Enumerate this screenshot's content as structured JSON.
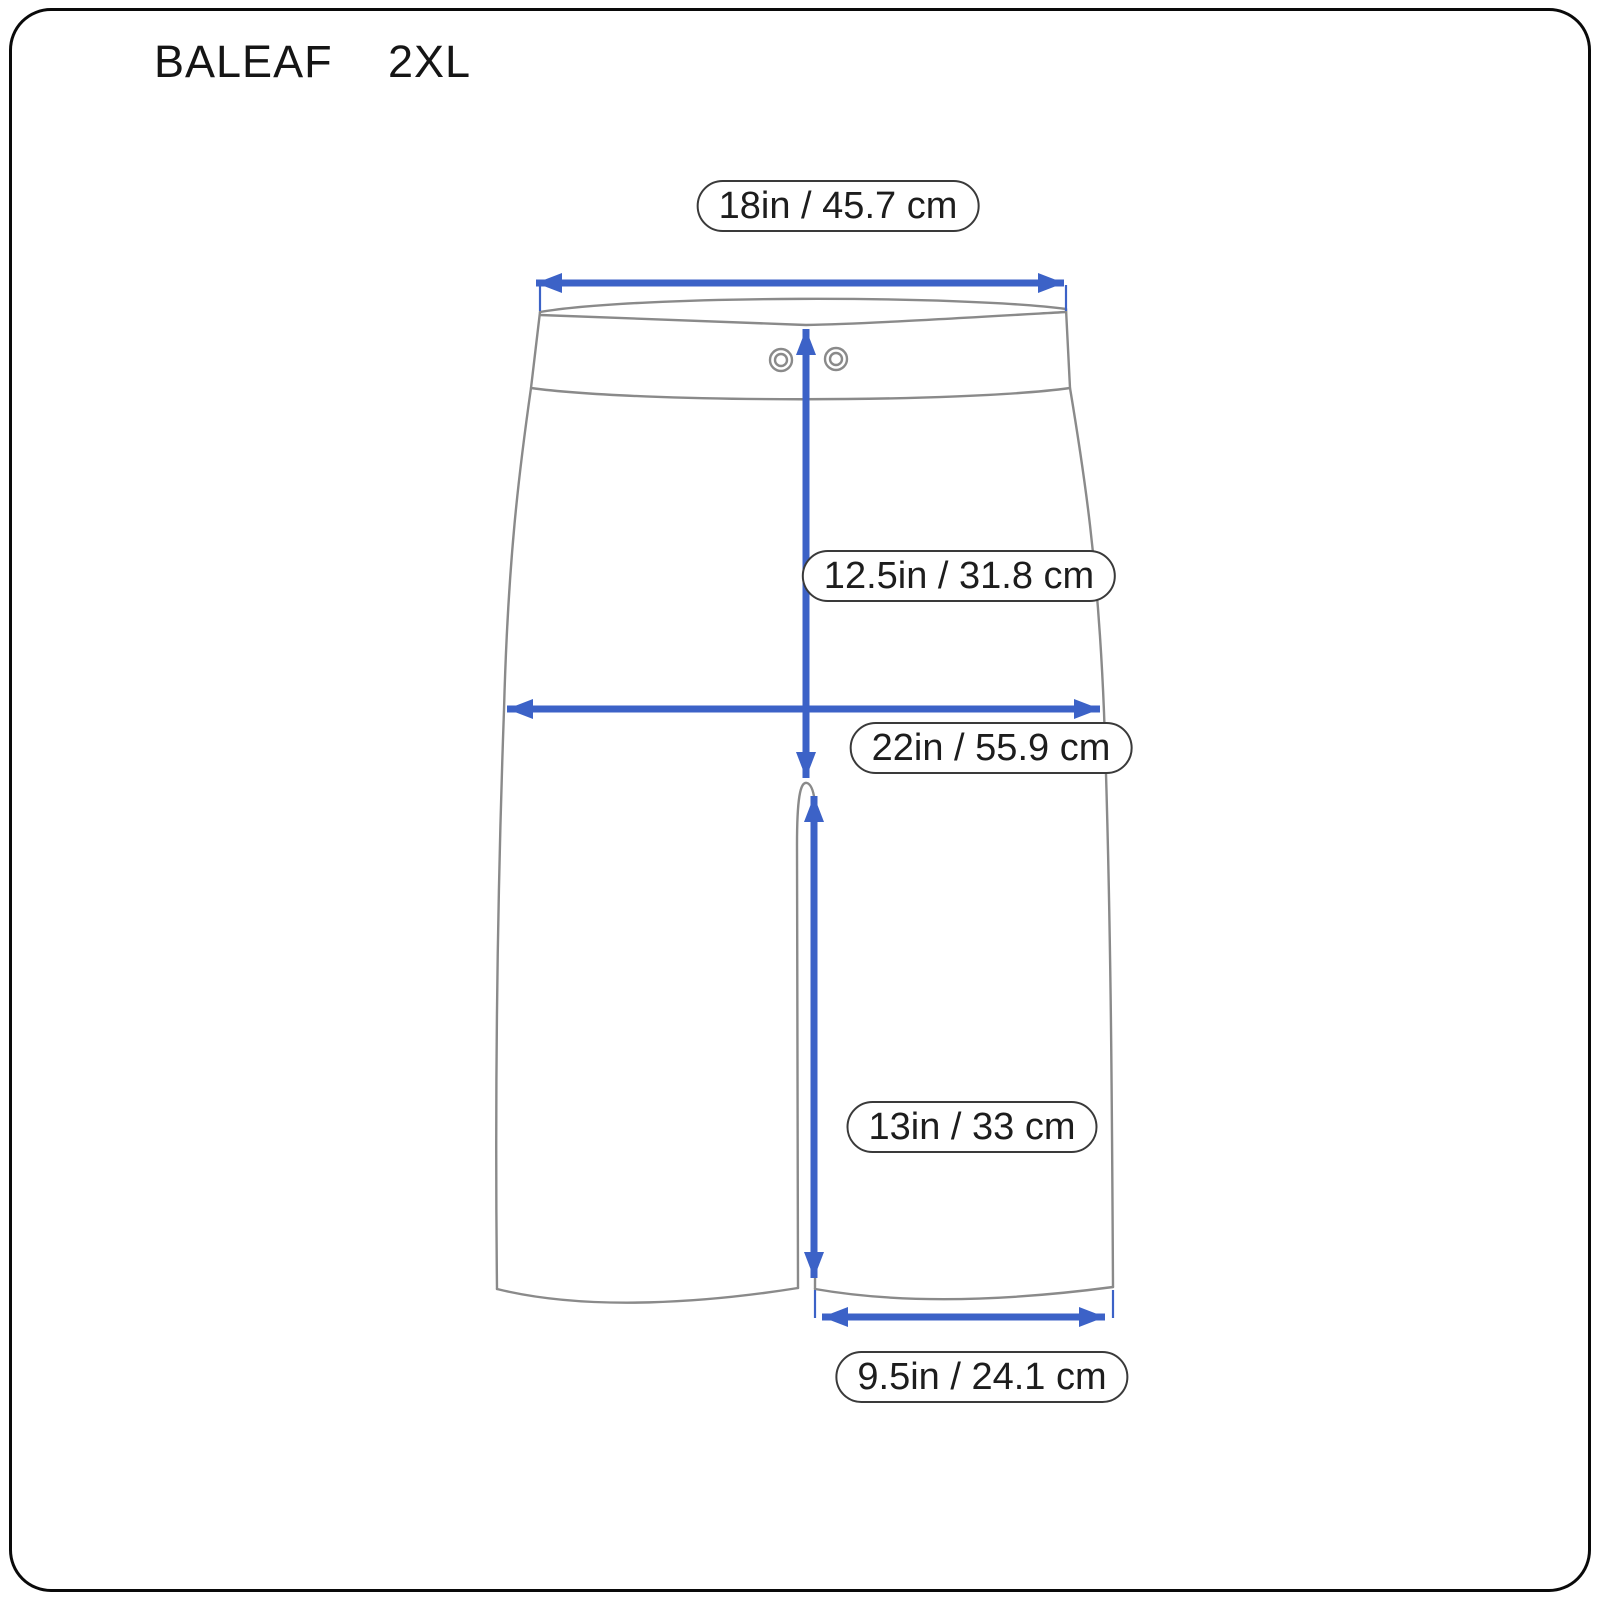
{
  "header": {
    "brand": "BALEAF",
    "size": "2XL"
  },
  "diagram": {
    "type": "garment-size-diagram",
    "garment": "shorts-front-view",
    "measurements": [
      {
        "id": "waist-width",
        "label": "18in / 45.7 cm"
      },
      {
        "id": "front-rise",
        "label": "12.5in / 31.8 cm"
      },
      {
        "id": "hip-width",
        "label": "22in / 55.9 cm"
      },
      {
        "id": "inseam",
        "label": "13in / 33 cm"
      },
      {
        "id": "leg-opening",
        "label": "9.5in / 24.1 cm"
      }
    ]
  },
  "colors": {
    "arrow_blue": "#3c62c7",
    "outline_gray": "#8a8a8a",
    "label_border": "#3a3a3a",
    "text": "#1d1d1d",
    "frame": "#0a0a0a",
    "background": "#ffffff"
  }
}
